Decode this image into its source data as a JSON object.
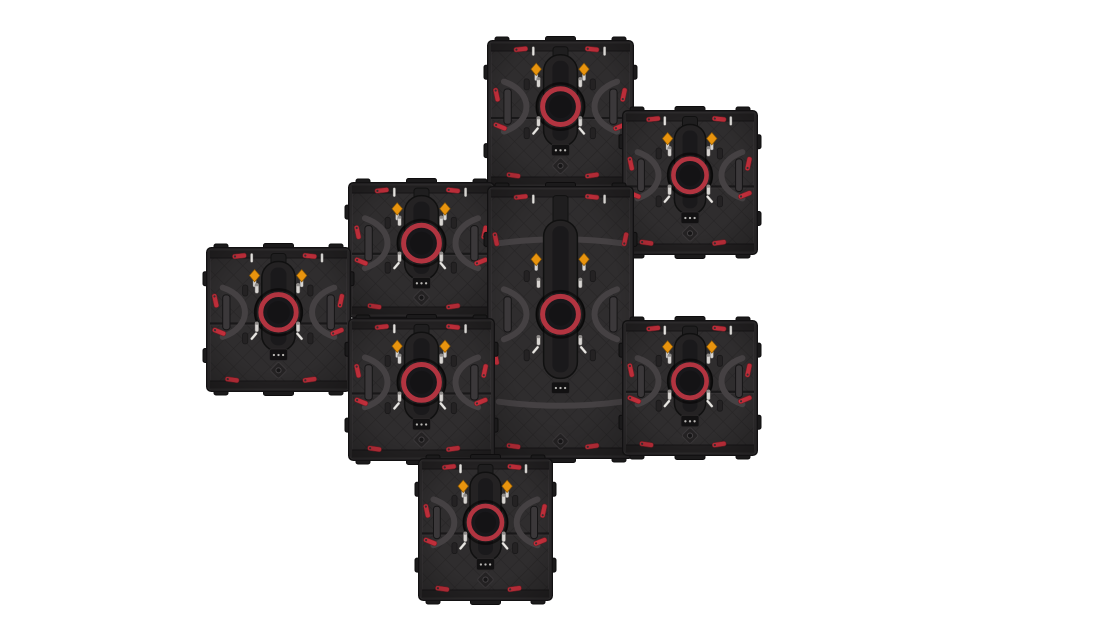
{
  "image": {
    "width": 1120,
    "height": 630,
    "background": "#ffffff",
    "subject": "Rear view of eight modular LED video-wall cabinets interlocked in a staggered mosaic",
    "panel_count": 8
  },
  "colors": {
    "background": "#ffffff",
    "cabinet_body": "#2e2c2d",
    "quilt_base": "#2f2d2e",
    "quilt_line": "#272526",
    "rail": "#232122",
    "outline": "#121112",
    "bevel": "#403c3e",
    "nub": "#1b1a1b",
    "spine": "#242223",
    "spine_edge": "#101010",
    "spine_inner": "#1a191b",
    "ring_red": "#b23440",
    "ring_center": "#18171a",
    "latch_orange": "#e8940e",
    "latch_orange_edge": "#8a5706",
    "lever_red": "#c22f3b",
    "lever_red_edge": "#6f1d24",
    "pin_silver": "#d8d5d2",
    "handle_pipe": "#454143",
    "tick_white": "#e9e7e3",
    "slot": "#242223",
    "dot_led": "#b9b7b4"
  },
  "panels": [
    {
      "id": "panel-top-center",
      "x": 487,
      "y": 40,
      "w": 147,
      "h": 148,
      "variant": "square"
    },
    {
      "id": "panel-top-right",
      "x": 622,
      "y": 110,
      "w": 136,
      "h": 145,
      "variant": "square"
    },
    {
      "id": "panel-upper-mid-left",
      "x": 348,
      "y": 182,
      "w": 147,
      "h": 136,
      "variant": "square"
    },
    {
      "id": "panel-center-tall",
      "x": 487,
      "y": 186,
      "w": 147,
      "h": 273,
      "variant": "tall"
    },
    {
      "id": "panel-far-left",
      "x": 206,
      "y": 247,
      "w": 145,
      "h": 145,
      "variant": "square"
    },
    {
      "id": "panel-lower-mid-left",
      "x": 348,
      "y": 318,
      "w": 147,
      "h": 143,
      "variant": "square"
    },
    {
      "id": "panel-mid-right",
      "x": 622,
      "y": 320,
      "w": 136,
      "h": 136,
      "variant": "square"
    },
    {
      "id": "panel-bottom-center",
      "x": 418,
      "y": 458,
      "w": 135,
      "h": 143,
      "variant": "square"
    }
  ]
}
